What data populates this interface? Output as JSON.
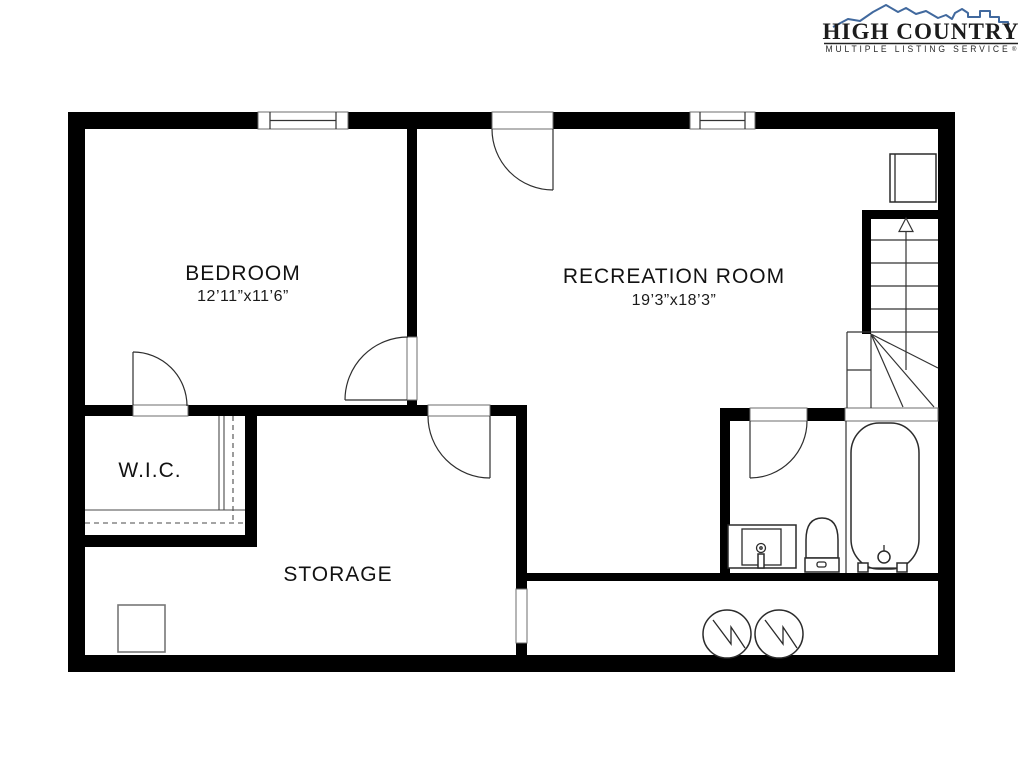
{
  "logo": {
    "title": "HIGH COUNTRY",
    "subtitle": "MULTIPLE LISTING SERVICE",
    "mark": "®"
  },
  "rooms": [
    {
      "name": "BEDROOM",
      "dims": "12’11”x11’6”"
    },
    {
      "name": "RECREATION ROOM",
      "dims": "19’3”x18’3”"
    },
    {
      "name": "W.I.C.",
      "dims": ""
    },
    {
      "name": "STORAGE",
      "dims": ""
    }
  ],
  "fixtures": [
    "window",
    "door-swing",
    "staircase-up-arrow",
    "closet-rod-and-shelf",
    "bathtub",
    "toilet",
    "vanity-sink",
    "water-heater-symbol",
    "appliance-square",
    "utility-square"
  ],
  "colors": {
    "wall": "#000000",
    "line": "#333333",
    "logo_blue": "#41699e",
    "logo_text": "#1c1c1c",
    "background": "#ffffff"
  }
}
